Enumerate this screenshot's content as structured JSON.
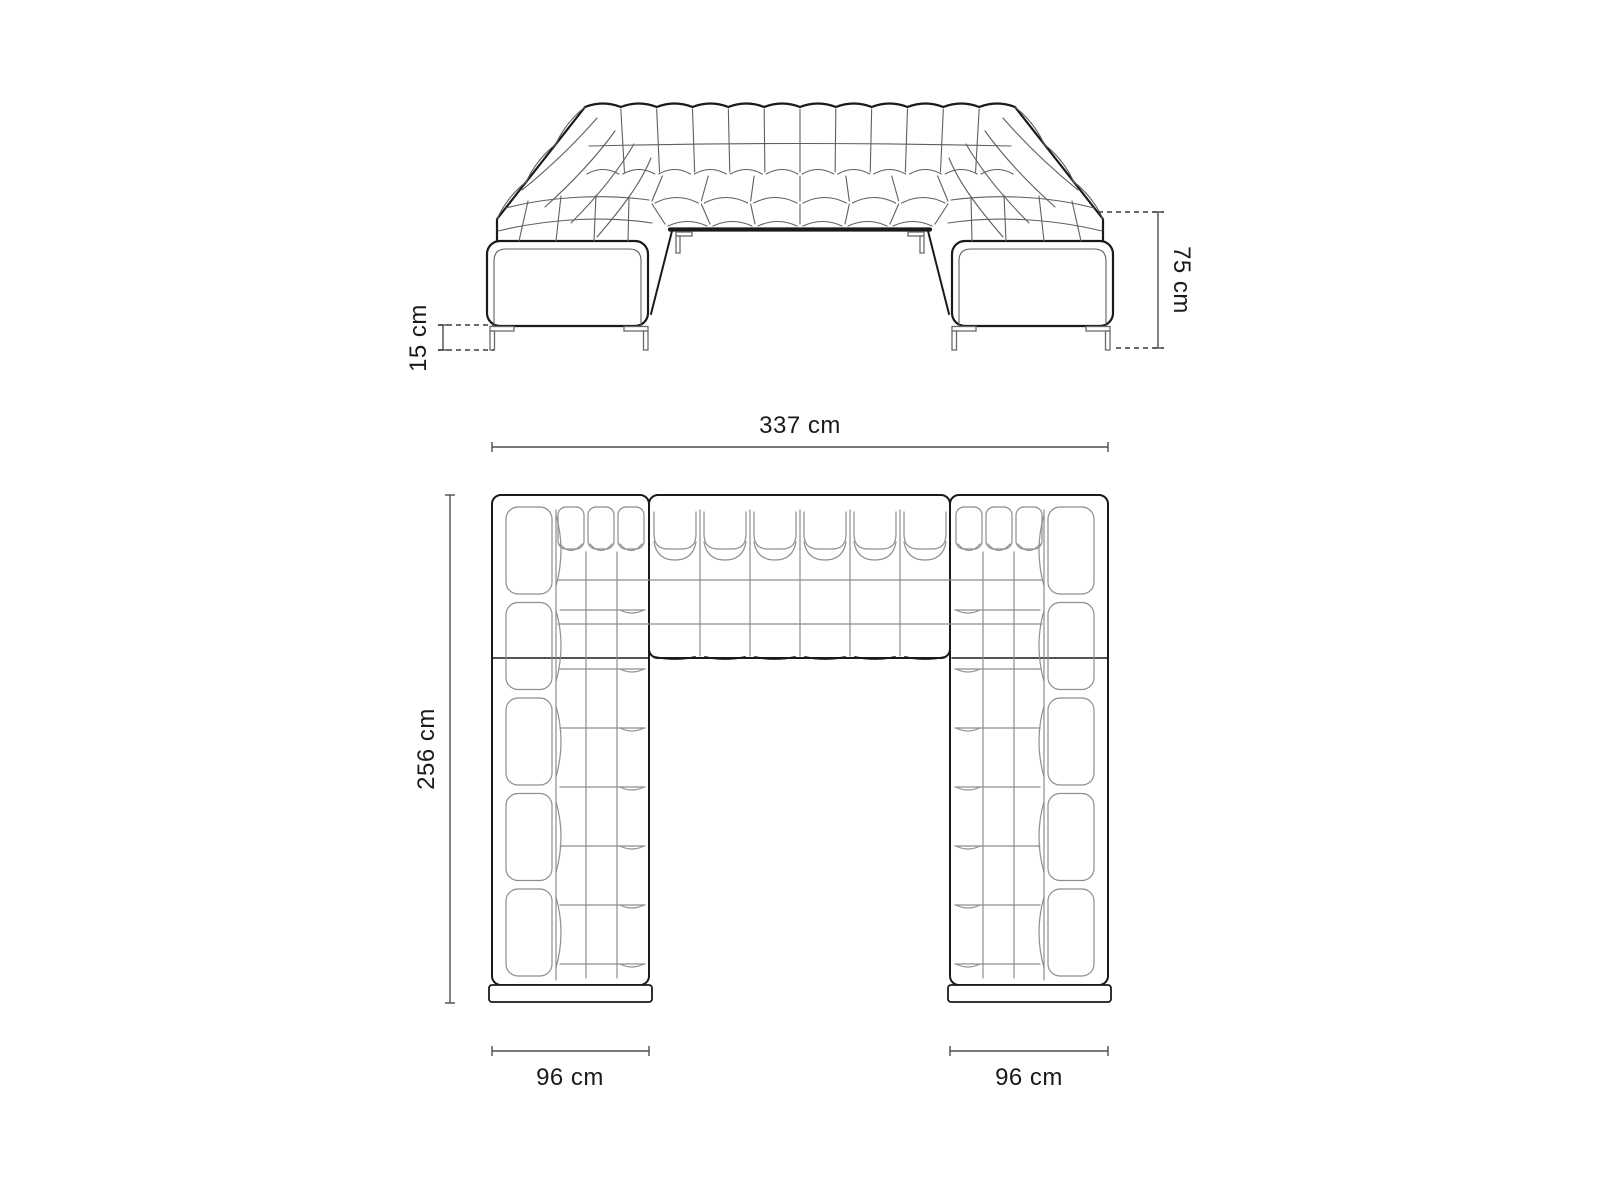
{
  "dimensions": {
    "total_width": "337 cm",
    "total_depth": "256 cm",
    "overall_height": "75 cm",
    "leg_height": "15 cm",
    "left_arm_width": "96 cm",
    "right_arm_width": "96 cm"
  },
  "colors": {
    "background": "#ffffff",
    "outline": "#1a1a1a",
    "tuft": "#5f5f5f",
    "grid": "#8e8e8e",
    "leg": "#6b6b6b",
    "dimension": "#4d4d4d",
    "dash": "#3d3d3d"
  }
}
